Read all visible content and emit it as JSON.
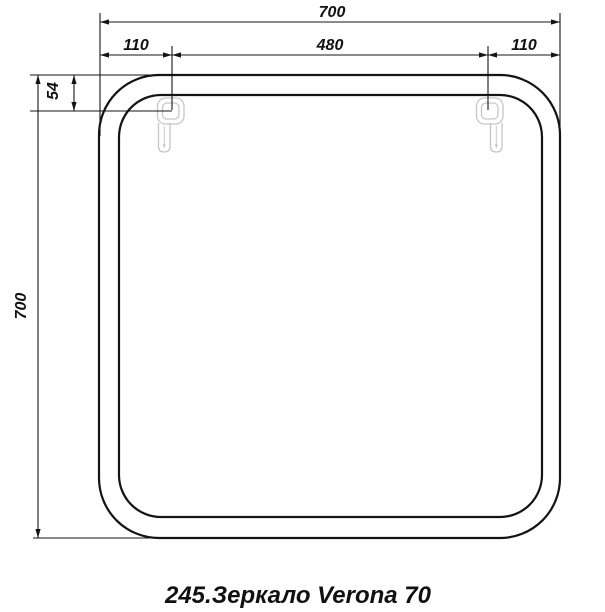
{
  "drawing": {
    "caption": "245.Зеркало Verona 70",
    "dimensions": {
      "top_total": "700",
      "top_left_segment": "110",
      "top_center_segment": "480",
      "top_right_segment": "110",
      "hook_drop": "54",
      "side_total": "700"
    },
    "colors": {
      "line": "#141414",
      "hook_outline": "#c6c6c6",
      "background": "#ffffff"
    }
  }
}
